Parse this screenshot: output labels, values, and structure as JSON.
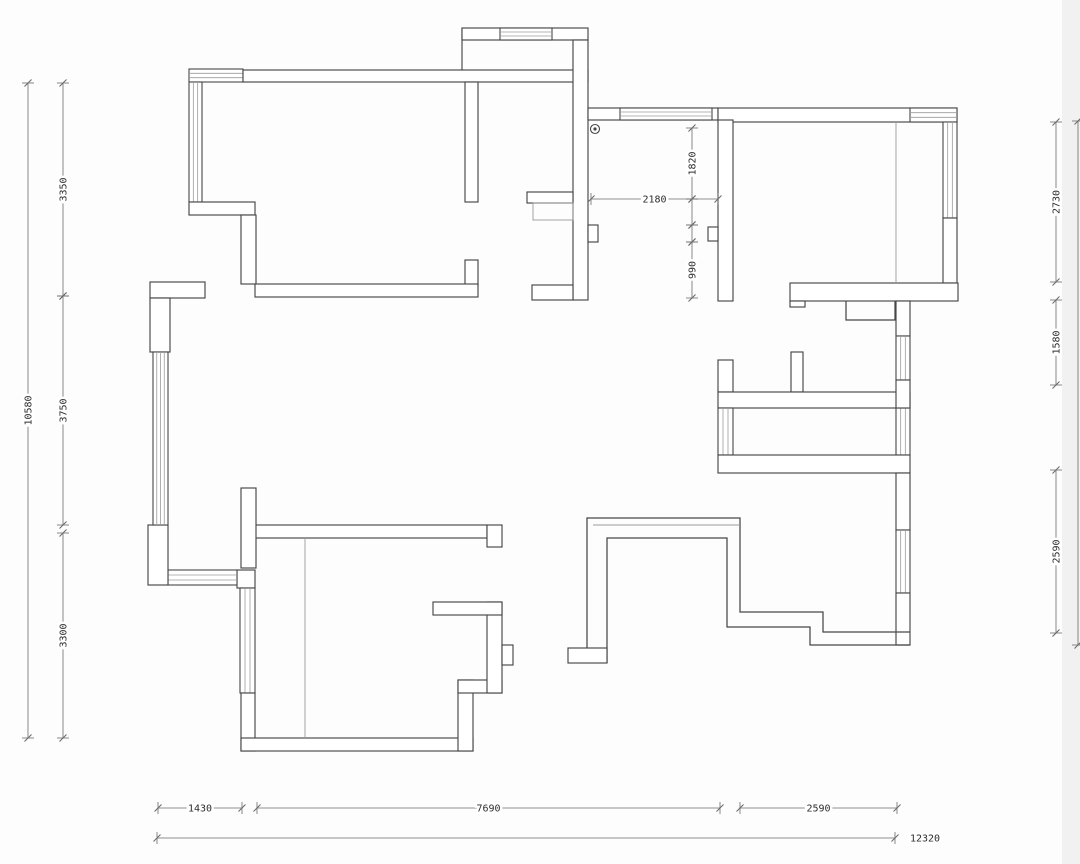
{
  "title": "apartment-floor-plan",
  "canvas": {
    "w": 1080,
    "h": 864
  },
  "colors": {
    "wall": "#474747",
    "thin": "#9b9b9b",
    "dim": "#6b6b6b",
    "text": "#2d2d2d",
    "bg": "#fdfdfd",
    "edge_shade": "#ededed"
  },
  "plan": {
    "elements": [
      {
        "t": "winh",
        "n": "window-top-left",
        "x": 189,
        "y": 69,
        "w": 54,
        "h": 13,
        "g": 2
      },
      {
        "t": "band",
        "n": "wall-bedroom-top",
        "x": 243,
        "y": 70,
        "w": 345,
        "h": 12
      },
      {
        "t": "winv",
        "n": "window-left-upper",
        "x": 189,
        "y": 82,
        "w": 13,
        "h": 120,
        "g": 2
      },
      {
        "t": "rect",
        "n": "wall-stub-left",
        "x": 189,
        "y": 202,
        "w": 66,
        "h": 13
      },
      {
        "t": "band",
        "n": "wall-bedroom-left",
        "x": 241,
        "y": 215,
        "w": 15,
        "h": 69
      },
      {
        "t": "band",
        "n": "wall-bedroom-right-upper",
        "x": 465,
        "y": 82,
        "w": 13,
        "h": 120
      },
      {
        "t": "rect",
        "n": "wall-bedroom-right-lower",
        "x": 465,
        "y": 260,
        "w": 13,
        "h": 26
      },
      {
        "t": "band",
        "n": "wall-bedroom-bottom",
        "x": 255,
        "y": 284,
        "w": 223,
        "h": 13
      },
      {
        "t": "line",
        "n": "bay-left-edge",
        "x1": 462,
        "y1": 28,
        "x2": 462,
        "y2": 70
      },
      {
        "t": "band",
        "n": "bay-top-wall",
        "x": 462,
        "y": 28,
        "w": 126,
        "h": 12
      },
      {
        "t": "winh",
        "n": "bay-window",
        "x": 500,
        "y": 28,
        "w": 52,
        "h": 12,
        "g": 2
      },
      {
        "t": "band",
        "n": "wall-entry-right",
        "x": 573,
        "y": 40,
        "w": 15,
        "h": 260
      },
      {
        "t": "rect",
        "n": "entry-stub-upper",
        "x": 527,
        "y": 192,
        "w": 46,
        "h": 11
      },
      {
        "t": "rectthin",
        "n": "entry-cabinet",
        "x": 533,
        "y": 203,
        "w": 40,
        "h": 17
      },
      {
        "t": "rect",
        "n": "entry-notch",
        "x": 588,
        "y": 225,
        "w": 10,
        "h": 17
      },
      {
        "t": "rect",
        "n": "entry-stub-lower",
        "x": 532,
        "y": 285,
        "w": 41,
        "h": 15
      },
      {
        "t": "band",
        "n": "wall-hall-top",
        "x": 588,
        "y": 108,
        "w": 130,
        "h": 12
      },
      {
        "t": "winh",
        "n": "window-hall-top",
        "x": 620,
        "y": 108,
        "w": 92,
        "h": 12,
        "g": 2
      },
      {
        "t": "band",
        "n": "wall-topright-top",
        "x": 718,
        "y": 108,
        "w": 239,
        "h": 14
      },
      {
        "t": "winh",
        "n": "window-topright-corner",
        "x": 910,
        "y": 108,
        "w": 47,
        "h": 14,
        "g": 2
      },
      {
        "t": "winv",
        "n": "window-right-upper",
        "x": 943,
        "y": 122,
        "w": 14,
        "h": 96,
        "g": 2
      },
      {
        "t": "band",
        "n": "wall-right-a",
        "x": 943,
        "y": 218,
        "w": 14,
        "h": 65
      },
      {
        "t": "band",
        "n": "wall-topright-left",
        "x": 718,
        "y": 120,
        "w": 15,
        "h": 181
      },
      {
        "t": "rect",
        "n": "wall-notch-left",
        "x": 708,
        "y": 227,
        "w": 10,
        "h": 14
      },
      {
        "t": "band",
        "n": "wall-topright-bottom",
        "x": 790,
        "y": 283,
        "w": 168,
        "h": 18
      },
      {
        "t": "rect",
        "n": "wall-foot",
        "x": 790,
        "y": 301,
        "w": 15,
        "h": 6
      },
      {
        "t": "poly",
        "n": "closet-outline",
        "pts": [
          [
            846,
            301
          ],
          [
            846,
            320
          ],
          [
            895,
            320
          ],
          [
            895,
            301
          ]
        ]
      },
      {
        "t": "line",
        "n": "wardrobe-line",
        "x1": 896,
        "y1": 122,
        "x2": 896,
        "y2": 283,
        "thin": true
      },
      {
        "t": "rect",
        "n": "pier-a",
        "x": 718,
        "y": 360,
        "w": 15,
        "h": 32
      },
      {
        "t": "rect",
        "n": "pier-b",
        "x": 791,
        "y": 352,
        "w": 12,
        "h": 40
      },
      {
        "t": "band",
        "n": "wall-shaft-top",
        "x": 718,
        "y": 392,
        "w": 192,
        "h": 16
      },
      {
        "t": "winv",
        "n": "window-shaft-left",
        "x": 718,
        "y": 408,
        "w": 15,
        "h": 47,
        "g": 2
      },
      {
        "t": "winv",
        "n": "window-shaft-right",
        "x": 896,
        "y": 408,
        "w": 14,
        "h": 47,
        "g": 2
      },
      {
        "t": "band",
        "n": "wall-shaft-bottom",
        "x": 718,
        "y": 455,
        "w": 192,
        "h": 18
      },
      {
        "t": "band",
        "n": "wall-right-b",
        "x": 896,
        "y": 301,
        "w": 14,
        "h": 35
      },
      {
        "t": "winv",
        "n": "window-right-mid",
        "x": 896,
        "y": 336,
        "w": 14,
        "h": 44,
        "g": 2
      },
      {
        "t": "band",
        "n": "wall-right-c",
        "x": 896,
        "y": 380,
        "w": 14,
        "h": 28
      },
      {
        "t": "band",
        "n": "wall-right-d",
        "x": 896,
        "y": 473,
        "w": 14,
        "h": 57
      },
      {
        "t": "winv",
        "n": "window-right-lower",
        "x": 896,
        "y": 530,
        "w": 14,
        "h": 63,
        "g": 2
      },
      {
        "t": "band",
        "n": "wall-right-e",
        "x": 896,
        "y": 593,
        "w": 14,
        "h": 52
      },
      {
        "t": "poly",
        "n": "stair-outer",
        "pts": [
          [
            587,
            650
          ],
          [
            587,
            518
          ],
          [
            740,
            518
          ],
          [
            740,
            612
          ],
          [
            823,
            612
          ],
          [
            823,
            632
          ],
          [
            910,
            632
          ]
        ]
      },
      {
        "t": "poly",
        "n": "stair-inner",
        "pts": [
          [
            607,
            663
          ],
          [
            607,
            538
          ],
          [
            727,
            538
          ],
          [
            727,
            627
          ],
          [
            810,
            627
          ],
          [
            810,
            645
          ],
          [
            910,
            645
          ]
        ]
      },
      {
        "t": "line",
        "n": "stair-mid-line",
        "x1": 593,
        "y1": 525,
        "x2": 740,
        "y2": 525,
        "thin": true
      },
      {
        "t": "rect",
        "n": "stair-foot",
        "x": 568,
        "y": 648,
        "w": 39,
        "h": 15
      },
      {
        "t": "band",
        "n": "wall-bottomleft-top",
        "x": 255,
        "y": 525,
        "w": 232,
        "h": 13
      },
      {
        "t": "rect",
        "n": "wall-endcap",
        "x": 487,
        "y": 525,
        "w": 15,
        "h": 22
      },
      {
        "t": "band",
        "n": "wall-pier-bottomleft",
        "x": 241,
        "y": 488,
        "w": 15,
        "h": 80
      },
      {
        "t": "rect",
        "n": "wall-corner-box",
        "x": 237,
        "y": 570,
        "w": 18,
        "h": 18
      },
      {
        "t": "winh",
        "n": "window-left-bottom",
        "x": 168,
        "y": 570,
        "w": 69,
        "h": 15,
        "g": 2
      },
      {
        "t": "rect",
        "n": "wall-left-box",
        "x": 148,
        "y": 525,
        "w": 20,
        "h": 60
      },
      {
        "t": "winv",
        "n": "window-bottomleft",
        "x": 240,
        "y": 588,
        "w": 15,
        "h": 105,
        "g": 2
      },
      {
        "t": "band",
        "n": "wall-bottomleft-left",
        "x": 241,
        "y": 693,
        "w": 14,
        "h": 58
      },
      {
        "t": "band",
        "n": "wall-bottomleft-bottom",
        "x": 241,
        "y": 738,
        "w": 232,
        "h": 13
      },
      {
        "t": "band",
        "n": "wall-bl-right-v",
        "x": 458,
        "y": 680,
        "w": 15,
        "h": 71
      },
      {
        "t": "band",
        "n": "wall-bl-h1",
        "x": 458,
        "y": 680,
        "w": 44,
        "h": 13
      },
      {
        "t": "band",
        "n": "wall-bl-v2",
        "x": 487,
        "y": 602,
        "w": 15,
        "h": 91
      },
      {
        "t": "rect",
        "n": "wall-bump",
        "x": 502,
        "y": 645,
        "w": 11,
        "h": 20
      },
      {
        "t": "band",
        "n": "wall-bl-h2",
        "x": 433,
        "y": 602,
        "w": 69,
        "h": 13
      },
      {
        "t": "line",
        "n": "closet-line",
        "x1": 305,
        "y1": 538,
        "x2": 305,
        "y2": 738,
        "thin": true
      },
      {
        "t": "rect",
        "n": "wall-jog-h",
        "x": 150,
        "y": 282,
        "w": 55,
        "h": 16
      },
      {
        "t": "rect",
        "n": "wall-jog-v",
        "x": 150,
        "y": 298,
        "w": 20,
        "h": 54
      },
      {
        "t": "winv",
        "n": "window-left-mid",
        "x": 153,
        "y": 352,
        "w": 15,
        "h": 173,
        "g": 3
      }
    ]
  },
  "symbols": {
    "peephole": {
      "x": 595,
      "y": 129
    }
  },
  "dimensions": [
    {
      "axis": "v",
      "x": 28,
      "name": "dim-left-overall",
      "segs": [
        {
          "from": 83,
          "to": 738,
          "label": "10580"
        }
      ]
    },
    {
      "axis": "v",
      "x": 63,
      "name": "dim-left-upper",
      "segs": [
        {
          "from": 83,
          "to": 296,
          "label": "3350"
        },
        {
          "from": 296,
          "to": 525,
          "label": "3750"
        }
      ]
    },
    {
      "axis": "v",
      "x": 63,
      "name": "dim-left-lower",
      "segs": [
        {
          "from": 533,
          "to": 738,
          "label": "3300"
        }
      ]
    },
    {
      "axis": "v",
      "x": 1056,
      "name": "dim-right-1",
      "segs": [
        {
          "from": 122,
          "to": 282,
          "label": "2730"
        }
      ]
    },
    {
      "axis": "v",
      "x": 1056,
      "name": "dim-right-2",
      "segs": [
        {
          "from": 300,
          "to": 385,
          "label": "1580"
        }
      ]
    },
    {
      "axis": "v",
      "x": 1056,
      "name": "dim-right-3",
      "segs": [
        {
          "from": 470,
          "to": 633,
          "label": "2590"
        }
      ]
    },
    {
      "axis": "v",
      "x": 1078,
      "name": "dim-right-clipped",
      "segs": [
        {
          "from": 121,
          "to": 645,
          "label": ""
        }
      ]
    },
    {
      "axis": "v",
      "x": 692,
      "name": "dim-interior-v",
      "segs": [
        {
          "from": 128,
          "to": 199,
          "label": "1820"
        },
        {
          "from": 199,
          "to": 225,
          "label": ""
        },
        {
          "from": 225,
          "to": 242,
          "label": ""
        },
        {
          "from": 242,
          "to": 298,
          "label": "990"
        }
      ]
    },
    {
      "axis": "h",
      "y": 199,
      "name": "dim-interior-h",
      "segs": [
        {
          "from": 591,
          "to": 718,
          "label": "2180"
        }
      ]
    },
    {
      "axis": "h",
      "y": 808,
      "name": "dim-bottom-1",
      "segs": [
        {
          "from": 158,
          "to": 242,
          "label": "1430"
        }
      ]
    },
    {
      "axis": "h",
      "y": 808,
      "name": "dim-bottom-2",
      "segs": [
        {
          "from": 257,
          "to": 720,
          "label": "7690"
        }
      ]
    },
    {
      "axis": "h",
      "y": 808,
      "name": "dim-bottom-3",
      "segs": [
        {
          "from": 740,
          "to": 897,
          "label": "2590"
        }
      ]
    },
    {
      "axis": "h",
      "y": 838,
      "name": "dim-bottom-total",
      "segs": [
        {
          "from": 157,
          "to": 895,
          "label": "12320",
          "lx": 925
        }
      ]
    }
  ]
}
